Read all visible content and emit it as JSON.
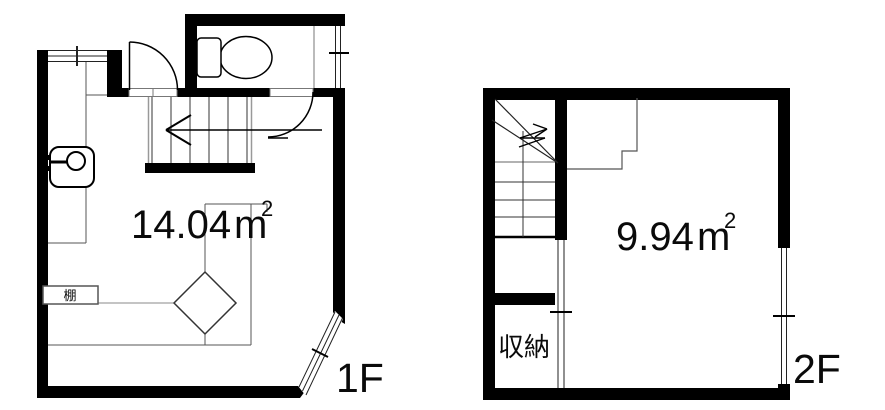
{
  "plan": {
    "background": "#ffffff",
    "wall_color": "#000000",
    "line_color": "#333333"
  },
  "floors": [
    {
      "name": "1F",
      "area_value": "14.04",
      "area_unit": "m",
      "area_exponent": "2",
      "shelf_label": "棚",
      "fixtures": [
        "toilet",
        "sink",
        "staircase-down-arrow",
        "entrance-door",
        "toilet-door",
        "shelf",
        "column",
        "top-window",
        "toilet-window",
        "corner-bay-window",
        "kitchen-counter"
      ]
    },
    {
      "name": "2F",
      "area_value": "9.94",
      "area_unit": "m",
      "area_exponent": "2",
      "storage_label": "収納",
      "fixtures": [
        "staircase-up-arrow",
        "storage-closet",
        "side-window",
        "partition-opening",
        "stairwell-step-outline"
      ]
    }
  ]
}
